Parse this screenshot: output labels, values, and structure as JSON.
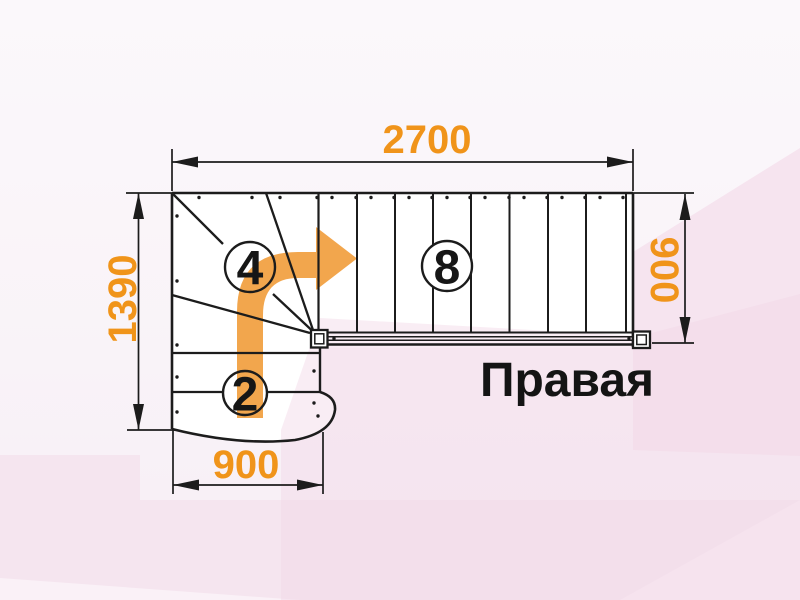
{
  "drawing": {
    "type_label": "stair-plan-top-view",
    "orientation_label": "Правая",
    "dimensions": {
      "top_width": "2700",
      "left_height": "1390",
      "right_width": "900",
      "bottom_width": "900"
    },
    "step_counts": {
      "winder_flight": "4",
      "upper_flight": "8",
      "lower_flight": "2"
    },
    "colors": {
      "dimension_text": "#F0941A",
      "direction_arrow": "#F2A64D",
      "outline": "#1C1C1C",
      "background_tint": "#F5E5EF"
    }
  }
}
